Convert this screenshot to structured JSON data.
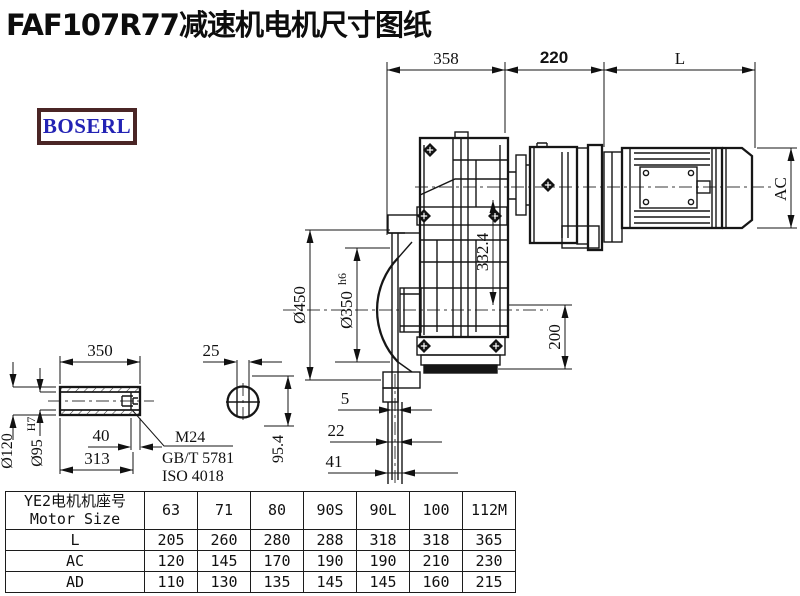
{
  "title": "FAF107R77减速机电机尺寸图纸",
  "logo": {
    "text": "BOSERL",
    "text_color": "#2323b4",
    "border_color": "#4a2525"
  },
  "drawing": {
    "dims": {
      "top_width": "358",
      "top_mid": "220",
      "motor_len": "L",
      "ac": "AC",
      "center_dist": "332.4",
      "flange_od": "Ø450",
      "spigot": "Ø350",
      "spigot_tol": "h6",
      "foot": "200",
      "off1": "5",
      "off2": "22",
      "off3": "41",
      "sec_height": "95.4",
      "shaft_len": "350",
      "key_w": "25",
      "hub_od": "Ø120",
      "bore": "Ø95",
      "bore_tol": "H7",
      "plug_len": "40",
      "key_len": "313",
      "bolt": "M24",
      "std_gb": "GB/T 5781",
      "std_iso": "ISO 4018"
    }
  },
  "table": {
    "header": {
      "line1": "YE2电机机座号",
      "line2": "Motor Size"
    },
    "columns": [
      "63",
      "71",
      "80",
      "90S",
      "90L",
      "100",
      "112M"
    ],
    "rows": [
      {
        "label": "L",
        "values": [
          "205",
          "260",
          "280",
          "288",
          "318",
          "318",
          "365"
        ]
      },
      {
        "label": "AC",
        "values": [
          "120",
          "145",
          "170",
          "190",
          "190",
          "210",
          "230"
        ]
      },
      {
        "label": "AD",
        "values": [
          "110",
          "130",
          "135",
          "145",
          "145",
          "160",
          "215"
        ]
      }
    ]
  }
}
